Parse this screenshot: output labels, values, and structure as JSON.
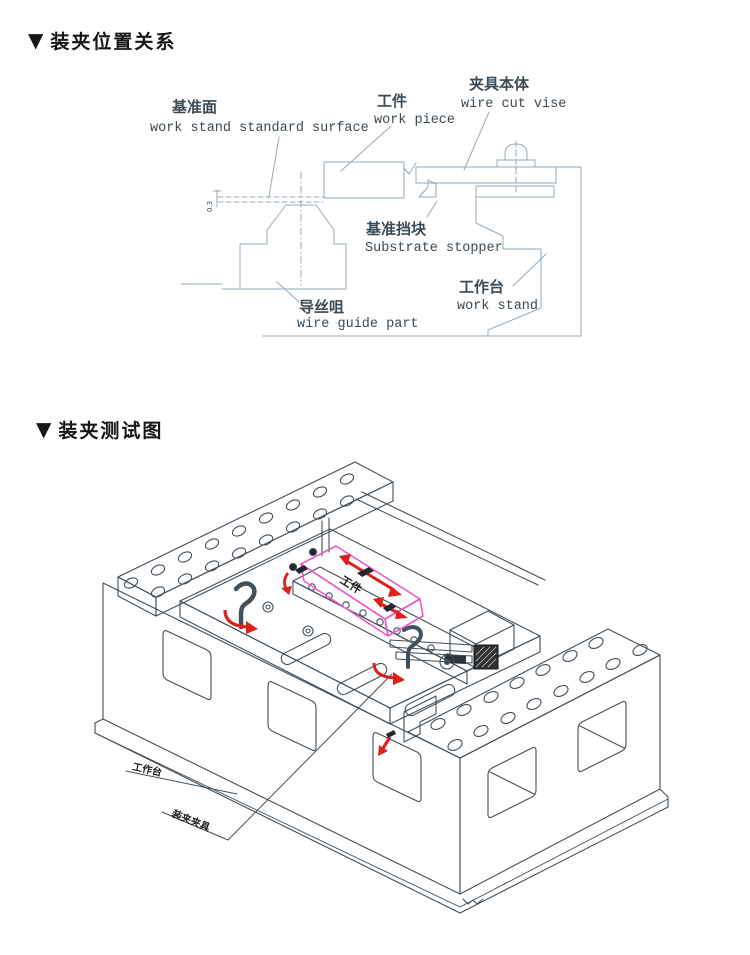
{
  "page": {
    "marker": "▼",
    "background": "#ffffff"
  },
  "colors": {
    "diagram1_line": "#96abb9",
    "diagram1_text": "#3b4a55",
    "diagram2_line": "#42505c",
    "workpiece_outline_pink": "#ee59c8",
    "motion_arrow_red": "#de201a",
    "label_black": "#1c1c1c"
  },
  "section1": {
    "title": "装夹位置关系",
    "labels": {
      "standard_surface": {
        "zh": "基准面",
        "en": "work stand standard surface"
      },
      "work_piece": {
        "zh": "工件",
        "en": "work piece"
      },
      "wire_cut_vise": {
        "zh": "夹具本体",
        "en": "wire cut vise"
      },
      "substrate_stopper": {
        "zh": "基准挡块",
        "en": "Substrate stopper"
      },
      "wire_guide": {
        "zh": "导丝咀",
        "en": "wire guide part"
      },
      "work_stand": {
        "zh": "工作台",
        "en": "work stand"
      },
      "dimension": "0.3"
    }
  },
  "section2": {
    "title": "装夹测试图",
    "labels": {
      "work_piece": "工件",
      "work_stand": "工作台",
      "fixture": "装夹夹具"
    }
  }
}
